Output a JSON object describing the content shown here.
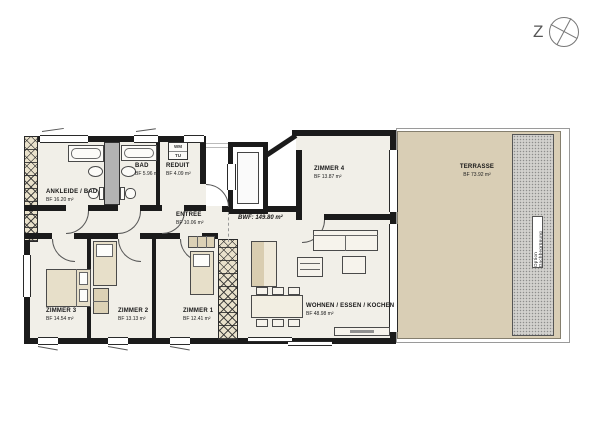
{
  "compass": {
    "letter": "Z"
  },
  "plan": {
    "bwf_label": "BWF: 149.80 m²",
    "rooms": [
      {
        "id": "ankleide",
        "name": "ANKLEIDE / BAD",
        "area": "BF 16.20 m²"
      },
      {
        "id": "bad",
        "name": "BAD",
        "area": "BF 5.96 m²"
      },
      {
        "id": "reduit",
        "name": "REDUIT",
        "area": "BF 4.09 m²"
      },
      {
        "id": "entree",
        "name": "ENTRÉE",
        "area": "BF 10.06 m²"
      },
      {
        "id": "zimmer4",
        "name": "ZIMMER 4",
        "area": "BF 13.87 m²"
      },
      {
        "id": "terrasse",
        "name": "TERRASSE",
        "area": "BF 73.92 m²"
      },
      {
        "id": "zimmer3",
        "name": "ZIMMER 3",
        "area": "BF 14.54 m²"
      },
      {
        "id": "zimmer2",
        "name": "ZIMMER 2",
        "area": "BF 13.13 m²"
      },
      {
        "id": "zimmer1",
        "name": "ZIMMER 1",
        "area": "BF 12.41 m²"
      },
      {
        "id": "wohnen",
        "name": "WOHNEN / ESSEN / KOCHEN",
        "area": "BF 48.98 m²"
      }
    ],
    "annotations": {
      "green_roof_option": "Option Dachbegrünung",
      "washer": "WM",
      "dryer": "TU"
    },
    "colors": {
      "floor": "#f1efe8",
      "terrace": "#d9ceb5",
      "wall": "#1b1b1b",
      "furniture_beige": "#e7dfc9",
      "shaft_gray": "#b3b3b3"
    }
  }
}
